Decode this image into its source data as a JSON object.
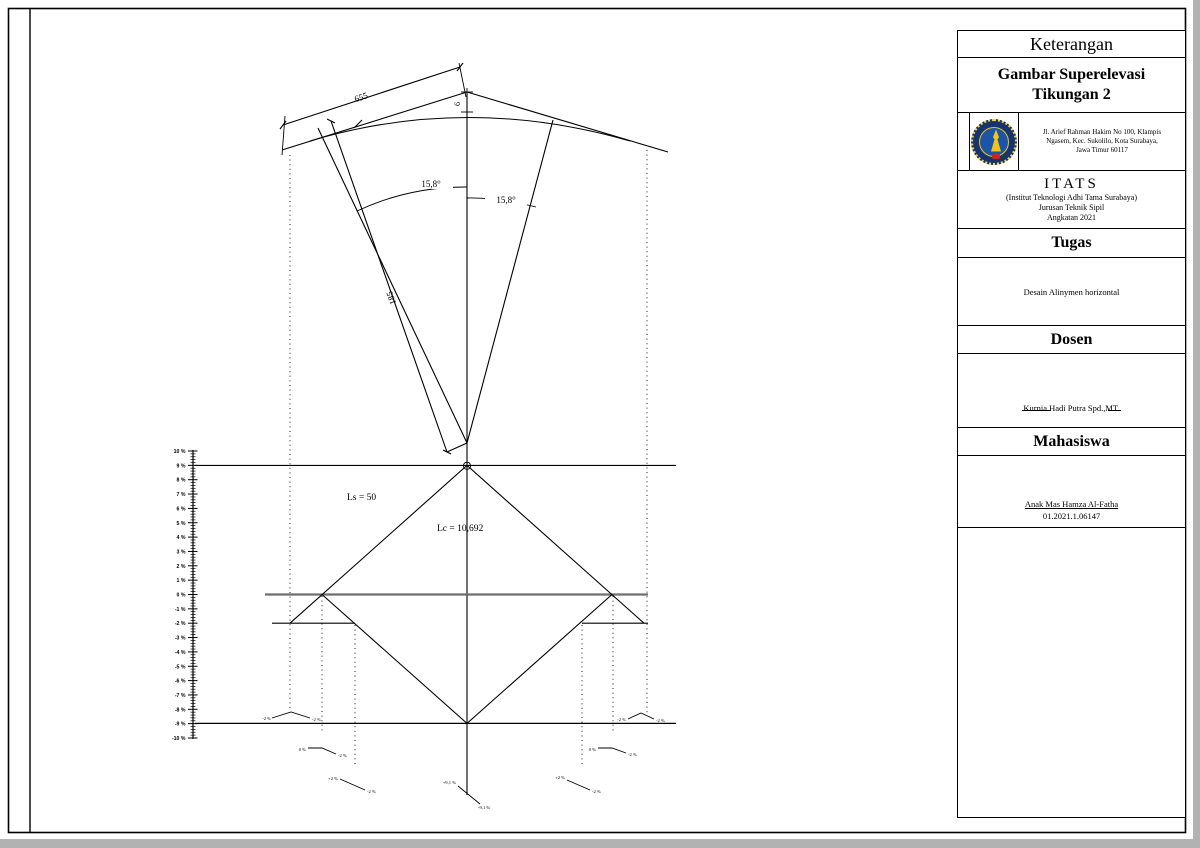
{
  "title_block": {
    "keterangan": "Keterangan",
    "drawing_title_line1": "Gambar Superelevasi",
    "drawing_title_line2": "Tikungan 2",
    "logo": "itats-emblem",
    "address_line1": "Jl. Arief Rahman Hakim No 100, Klampis",
    "address_line2": "Ngasem, Kec. Sukolilo, Kota Surabaya,",
    "address_line3": "Jawa Timur 60117",
    "institute_abbr": "ITATS",
    "institute_full": "(Institut Teknologi Adhi Tama Surabaya)",
    "department": "Jurusan Teknik Sipil",
    "batch": "Angkatan 2021",
    "tugas_header": "Tugas",
    "tugas_content": "Desain Alinymen horizontal",
    "dosen_header": "Dosen",
    "dosen_name": "Kurnia Hadi Putra Spd.,MT.",
    "mahasiswa_header": "Mahasiswa",
    "student_name": "Anak Mas Hamza Al-Fatha",
    "student_id": "01.2021.1.06147"
  },
  "plan": {
    "dim_tangent": "655",
    "dim_external": "6",
    "dim_radius": "185",
    "angle_left": "15,8°",
    "angle_right": "15,8°"
  },
  "diagram": {
    "ls_label": "Ls = 50",
    "lc_label": "Lc = 10,692",
    "axis_labels": [
      "10 %",
      "9 %",
      "8 %",
      "7 %",
      "6 %",
      "5 %",
      "4 %",
      "3 %",
      "2 %",
      "1 %",
      "0 %",
      "-1 %",
      "-2 %",
      "-3 %",
      "-4 %",
      "-5 %",
      "-6 %",
      "-7 %",
      "-8 %",
      "-9 %",
      "-10 %"
    ],
    "axis_max_pct": 10,
    "axis_min_pct": -10,
    "major_step_pct": 1,
    "minor_step_pct": 0.2,
    "emax_label_pos": "+9,1 %",
    "emax_label_neg": "-9,1 %"
  },
  "xsections": {
    "left": [
      {
        "a": "-2 %",
        "b": "-2 %"
      },
      {
        "a": "0 %",
        "b": "-2 %"
      },
      {
        "a": "+2 %",
        "b": "-2 %"
      }
    ],
    "center": {
      "a": "+9,1 %",
      "b": "-9,1 %"
    },
    "right": [
      {
        "a": "-2 %",
        "b": "-2 %"
      },
      {
        "a": "0 %",
        "b": "-2 %"
      },
      {
        "a": "+2 %",
        "b": "-2 %"
      }
    ]
  }
}
